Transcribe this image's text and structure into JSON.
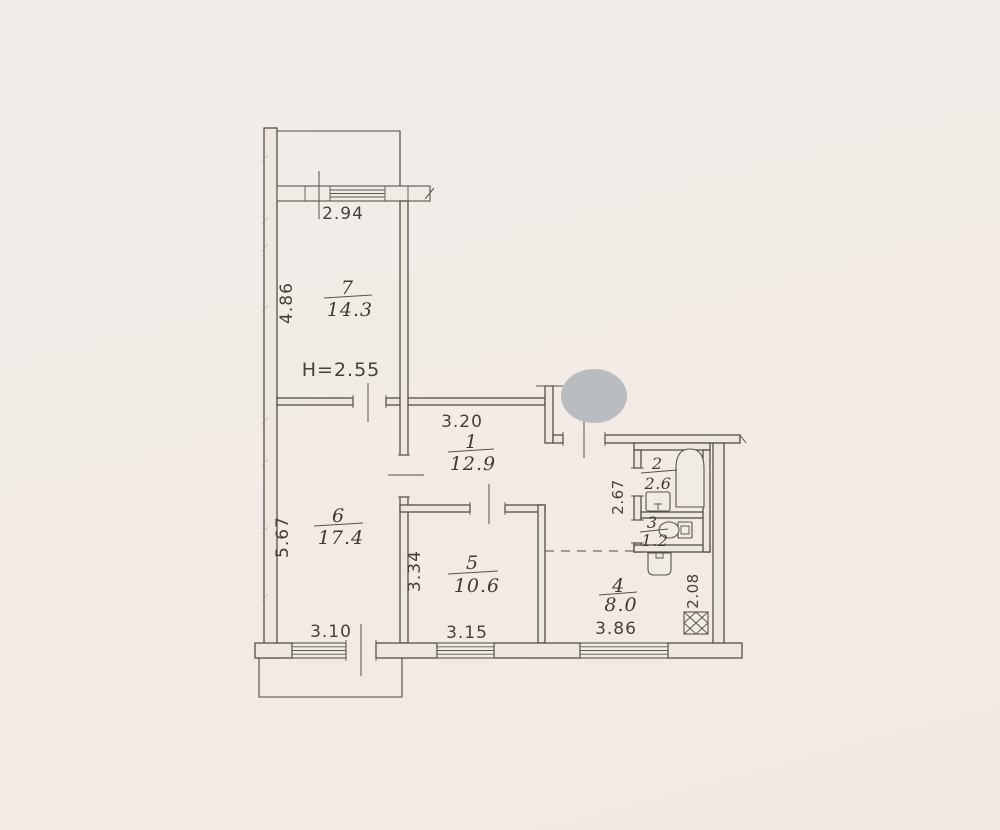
{
  "plan": {
    "title": "apartment-floor-plan",
    "ceiling_height_note": "H=2.55",
    "rooms": {
      "r1": {
        "number": "1",
        "area": "12.9"
      },
      "r2": {
        "number": "2",
        "area": "2.6"
      },
      "r3": {
        "number": "3",
        "area": "1.2"
      },
      "r4": {
        "number": "4",
        "area": "8.0"
      },
      "r5": {
        "number": "5",
        "area": "10.6"
      },
      "r6": {
        "number": "6",
        "area": "17.4"
      },
      "r7": {
        "number": "7",
        "area": "14.3"
      }
    },
    "dimensions": {
      "window_top": "2.94",
      "room7_depth": "4.86",
      "hall_width": "3.20",
      "room6_depth": "5.67",
      "room5_depth": "3.34",
      "room6_width": "3.10",
      "room5_width": "3.15",
      "bath_depth": "2.67",
      "kitchen_width": "3.86",
      "kitchen_depth": "2.08"
    },
    "fixtures": [
      "bathtub",
      "wash-basin",
      "toilet",
      "kitchen-sink",
      "ventilation-shaft"
    ],
    "colors": {
      "paper": "#f1ece7",
      "ink": "#4d4944",
      "redaction": "#b9bdc0"
    }
  }
}
